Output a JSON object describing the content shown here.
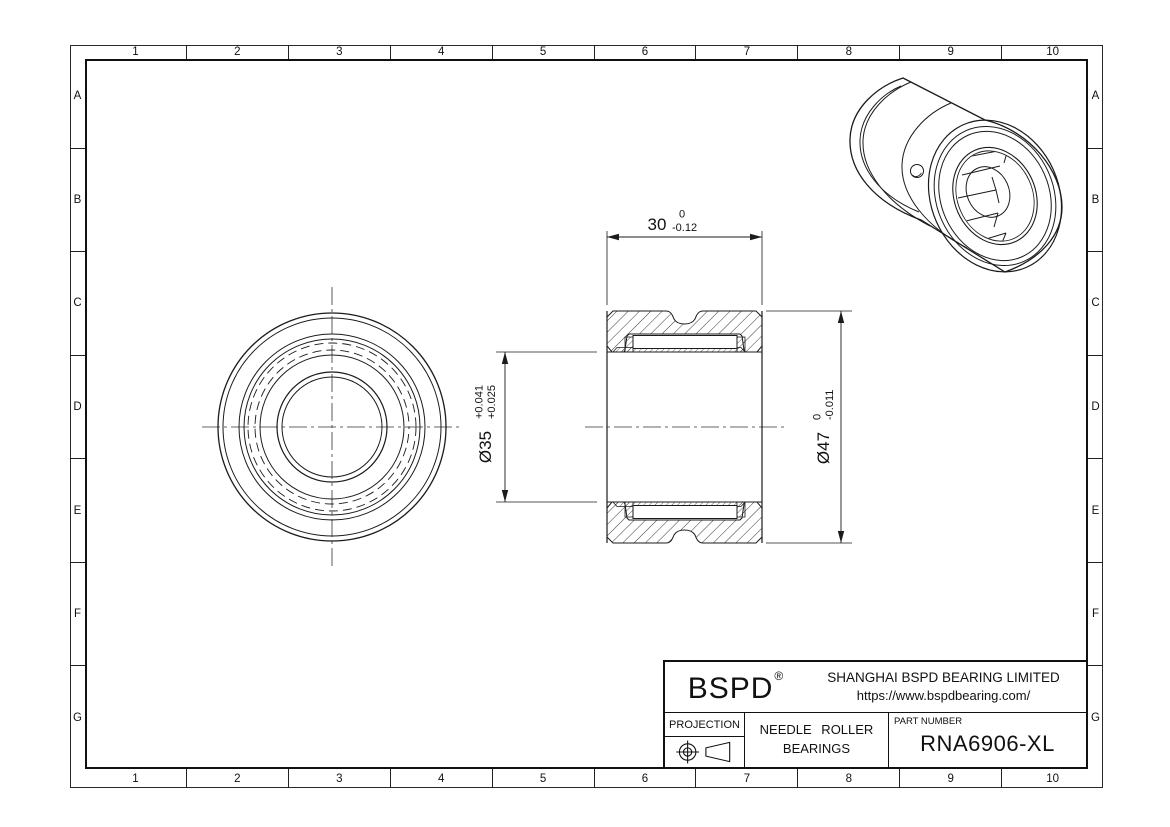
{
  "grid": {
    "columns": [
      "1",
      "2",
      "3",
      "4",
      "5",
      "6",
      "7",
      "8",
      "9",
      "10"
    ],
    "rows": [
      "A",
      "B",
      "C",
      "D",
      "E",
      "F",
      "G"
    ]
  },
  "drawing": {
    "dims": {
      "width": {
        "nominal": "30",
        "tol_upper": "0",
        "tol_lower": "-0.12"
      },
      "bore": {
        "nominal": "Ø35",
        "tol_upper": "+0.041",
        "tol_lower": "+0.025"
      },
      "outer": {
        "nominal": "Ø47",
        "tol_upper": "0",
        "tol_lower": "-0.011"
      }
    }
  },
  "title_block": {
    "brand": "BSPD",
    "brand_mark": "®",
    "company": "SHANGHAI BSPD BEARING LIMITED",
    "website": "https://www.bspdbearing.com/",
    "projection_label": "PROJECTION",
    "projection_icon": "first-angle-projection-icon",
    "product_line1": "NEEDLE ROLLER",
    "product_line2": "BEARINGS",
    "part_number_label": "PART NUMBER",
    "part_number": "RNA6906-XL"
  },
  "colors": {
    "line": "#1b1b1b",
    "background": "#ffffff"
  }
}
